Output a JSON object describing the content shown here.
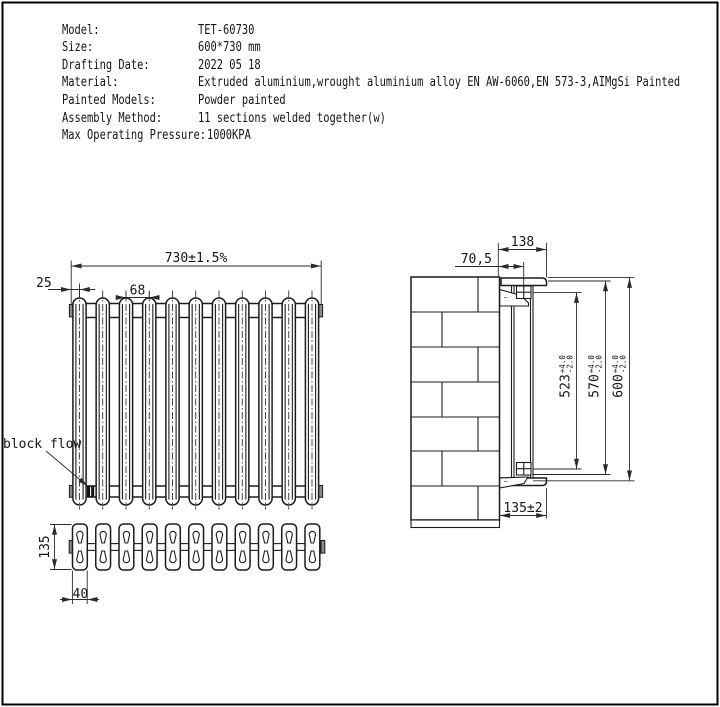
{
  "spec_table": {
    "rows": [
      {
        "label": "Model:",
        "value": "TET-60730"
      },
      {
        "label": "Size:",
        "value": "600*730 mm"
      },
      {
        "label": "Drafting Date:",
        "value": "2022 05 18"
      },
      {
        "label": "Material:",
        "value": "Extruded aluminium,wrought aluminium alloy EN AW-6060,EN 573-3,AIMgSi Painted"
      },
      {
        "label": "Painted Models:",
        "value": "Powder painted"
      },
      {
        "label": "Assembly Method:",
        "value": "11 sections welded together(w)"
      },
      {
        "label": "Max Operating Pressure:",
        "value": "1000KPA"
      }
    ]
  },
  "front_view": {
    "dim_overall": "730±1.5%",
    "dim_end_offset": "25",
    "dim_pitch": "68",
    "label_block_flow": "block flow"
  },
  "top_view": {
    "dim_depth": "135",
    "dim_section_width": "40"
  },
  "side_view": {
    "dim_total_depth": "138",
    "dim_wall_to_center": "70,5",
    "dim_inner_height": "523",
    "dim_bracket_height": "570",
    "dim_overall_height": "600",
    "tol_plus": "+4.0",
    "tol_minus": "-2.0",
    "dim_floor": "135±2"
  },
  "colors": {
    "line": "#1c1c1c",
    "dimension": "#2b2b2b",
    "cap_fill": "#8a8a8a",
    "plug_fill": "#141414"
  }
}
